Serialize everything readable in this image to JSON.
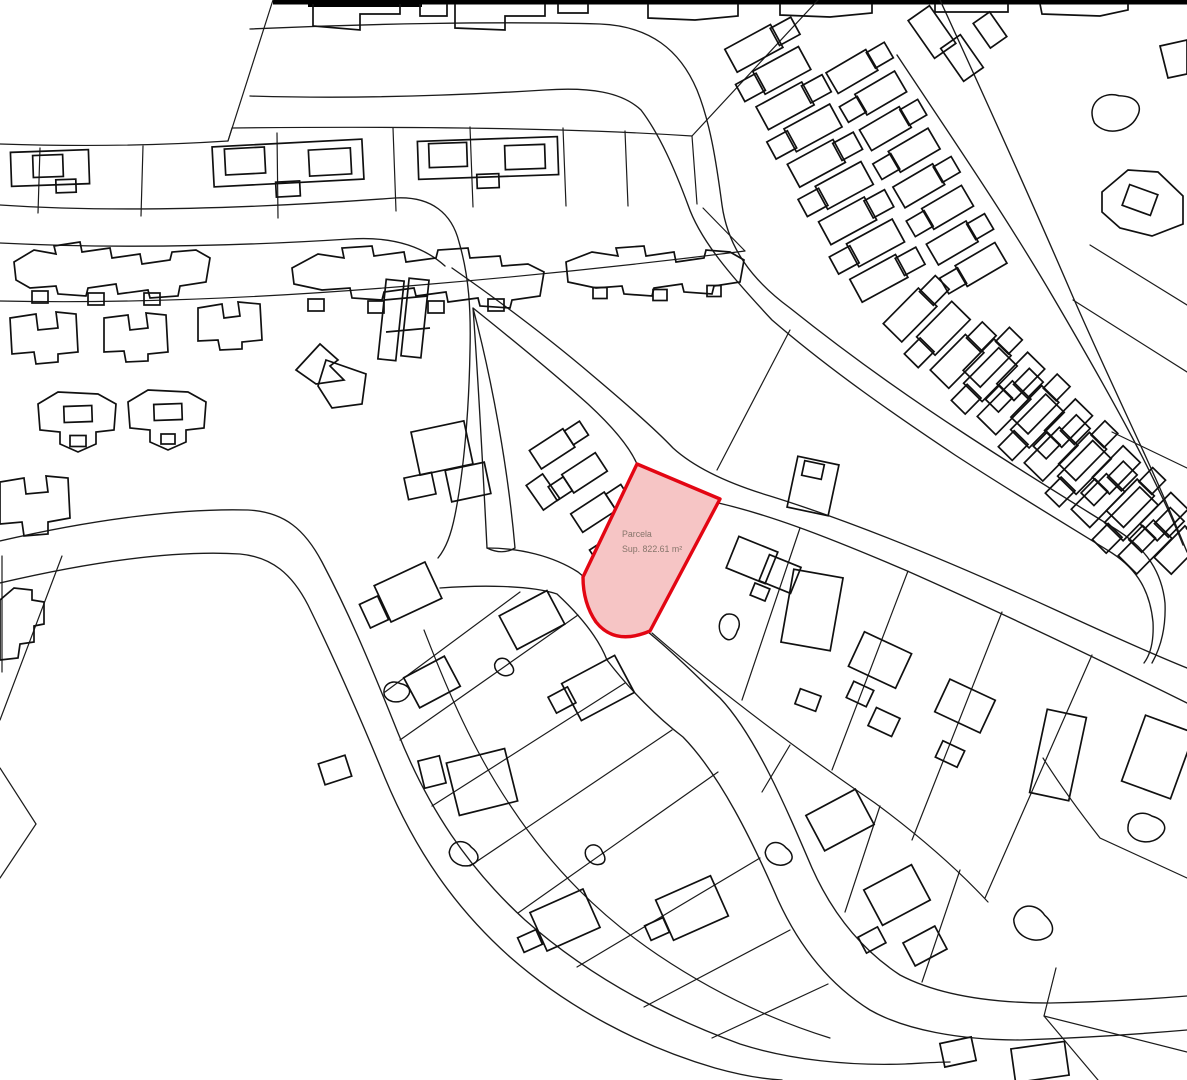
{
  "canvas": {
    "width": 1187,
    "height": 1080,
    "background": "#ffffff",
    "line_color": "#1b1b1b"
  },
  "parcel": {
    "label_line1": "Parcela",
    "label_line2": "Sup. 822.61 m²",
    "outline_color": "#e30613",
    "fill_color": "#f6c5c5",
    "label_color": "#86756b",
    "label_x": 622,
    "label_y1": 537,
    "label_y2": 552,
    "path": "M637,464 L720,499 L650,631 Q615,646 596,622 Q583,603 583,577 Z"
  },
  "map": {
    "top_bars": [
      [
        273,
        0,
        914,
        4.5
      ],
      [
        308,
        0,
        114,
        7
      ]
    ],
    "roads": [
      "M0,205 C120,213 260,208 395,198 C432,196 452,214 459,242 C469,276 471,310 470,350 C469,410 464,470 455,515 C451,535 446,548 438,558",
      "M0,243 C120,249 240,246 350,239 C395,236 425,248 445,266",
      "M473,308 C479,390 483,470 487,548 C497,553 507,553 515,548 C508,468 492,380 473,308 Z",
      "M487,548 C520,548 553,556 578,572 C600,590 625,615 648,632 C680,658 700,680 720,698 C755,735 785,805 812,868 C833,915 862,950 900,975 C938,995 992,1003 1050,1003 C1105,1002 1150,999 1187,996",
      "M440,588 C480,585 530,585 557,594 C585,620 600,642 607,660 C630,690 658,718 683,737 C720,775 752,840 778,900 C800,948 830,985 870,1010 C905,1030 960,1040 1020,1040 C1080,1038 1140,1034 1187,1030",
      "M0,541 C90,520 180,508 248,510 C285,512 305,530 322,562 C350,615 372,668 398,733 C428,808 468,868 525,920 C585,973 658,1014 740,1044 C790,1060 850,1066 905,1064 C925,1063 940,1062 950,1062",
      "M0,583 C90,562 175,550 240,554 C272,557 292,574 308,605 C335,660 358,712 385,778 C415,850 455,908 510,957 C568,1008 640,1046 715,1068 C740,1075 762,1079 782,1080",
      "M473,308 C508,336 550,370 588,404 C614,428 630,448 637,464 C645,480 670,494 699,499 C760,510 830,538 905,570 C1000,612 1100,660 1187,703",
      "M452,268 C495,298 545,335 592,375 C630,407 658,432 673,448 C695,468 730,484 770,496 C860,524 960,566 1060,612 C1110,635 1150,653 1187,668",
      "M250,96 C350,99 450,96 545,90 C590,87 622,92 641,110 C660,135 675,170 688,205 C700,240 730,275 772,320 C830,370 895,415 955,455 C1015,494 1072,528 1112,553 C1138,570 1150,592 1153,622 C1154,642 1150,655 1144,663",
      "M250,29 C360,24 500,21 600,24 C650,26 680,50 697,90 C710,122 716,160 722,205 C728,248 752,280 790,308 C845,352 905,395 965,434 C1023,472 1077,505 1117,530 C1147,549 1162,573 1165,603 C1166,627 1161,647 1152,663",
      "M897,55 C950,135 1005,215 1053,297 C1080,343 1107,390 1132,437 C1152,475 1170,512 1183,545",
      "M940,0 C985,98 1030,197 1073,297 C1097,352 1122,405 1145,455 C1162,492 1176,525 1187,552"
    ],
    "boundaries": [
      "M0,144 Q120,148 228,141",
      "M228,141 L273,0",
      "M40,148 L38,213",
      "M143,146 L141,216",
      "M277,133 L278,218",
      "M393,128 L396,211",
      "M470,127 L473,207",
      "M563,128 L566,206",
      "M625,131 L628,206",
      "M228,141 L232,128 Q420,126 560,130 Q630,132 692,136",
      "M692,136 L818,0",
      "M692,136 L697,204",
      "M0,301 C140,304 280,297 420,285 C540,275 650,263 745,251",
      "M745,251 L703,208",
      "M717,470 L790,330",
      "M1073,300 L1187,372",
      "M1112,432 L1187,468",
      "M1090,245 L1187,305",
      "M652,633 C720,692 795,748 875,803 C925,840 960,872 988,902",
      "M800,528 L742,700",
      "M908,571 L832,770",
      "M1002,612 L912,840",
      "M1092,655 L985,898",
      "M790,745 L762,792",
      "M880,806 L845,912",
      "M960,870 L922,982",
      "M424,630 C448,692 474,752 512,808 C552,868 600,916 658,955 C716,994 772,1020 830,1038",
      "M385,692 L520,592",
      "M400,740 L578,615",
      "M432,806 L625,683",
      "M470,866 L672,730",
      "M518,913 L718,772",
      "M577,967 L760,858",
      "M644,1007 L790,930",
      "M712,1038 L828,984",
      "M62,556 L0,720",
      "M0,768 L36,824",
      "M36,824 L0,878",
      "M2,556 L2,672",
      "M1043,758 C1063,790 1082,815 1100,838 L1187,878",
      "M1056,968 L1044,1016 L1098,1080",
      "M1044,1016 L1187,1052"
    ],
    "building_paths": [
      "M14,262 L34,250 L56,254 L54,246 L80,242 L82,252 L110,248 L112,258 L140,254 L142,264 L170,260 L172,252 L196,250 L210,258 L206,282 L180,286 L178,296 L150,298 L148,290 L118,294 L116,284 L88,288 L86,296 L58,294 L56,286 L30,288 L16,280 Z",
      "M292,268 L318,254 L344,258 L342,248 L372,246 L374,256 L404,252 L406,262 L436,258 L438,250 L468,248 L470,258 L500,256 L502,266 L528,264 L544,272 L540,296 L512,300 L510,308 L480,306 L478,298 L448,302 L446,292 L416,296 L414,288 L384,292 L382,300 L352,298 L350,288 L322,290 L294,284 Z",
      "M566,262 L592,252 L618,256 L616,248 L644,246 L646,256 L674,252 L676,262 L704,258 L706,250 L730,252 L744,260 L740,282 L714,286 L712,294 L684,292 L682,284 L654,288 L652,296 L624,294 L622,286 L596,288 L568,282 Z",
      "M10,318 L36,314 L38,330 L58,328 L56,312 L76,314 L78,352 L58,354 L58,362 L36,364 L34,352 L12,354 Z",
      "M104,318 L128,315 L130,330 L148,328 L146,313 L166,315 L168,352 L148,354 L148,361 L126,362 L124,351 L104,352 Z",
      "M198,308 L222,304 L224,318 L240,316 L238,302 L260,304 L262,340 L242,342 L242,349 L220,350 L218,340 L198,341 Z",
      "M38,404 L58,392 L98,394 L116,404 L114,430 L96,432 L96,444 L78,452 L60,444 L60,432 L40,430 Z",
      "M128,402 L148,390 L188,392 L206,402 L204,428 L186,430 L186,442 L168,450 L150,442 L150,430 L130,428 Z",
      "M296,370 L320,344 L338,360 L330,366 L344,380 L316,384 Z",
      "M326,360 L366,374 L362,404 L332,408 L318,386 Z",
      "M0,482 L24,478 L26,494 L48,492 L46,476 L68,478 L70,518 L48,522 L48,534 L24,536 L22,522 L0,524 Z",
      "M0,600 L14,588 L32,590 L32,600 L44,602 L44,624 L34,626 L34,642 L20,644 L18,658 L0,660 Z",
      "M1102,192 L1128,170 L1158,172 L1183,196 L1183,224 L1152,236 L1120,228 L1102,212 Z",
      "M1160,46 L1187,40 L1187,74 L1168,78 Z",
      "M384,300 L428,296",
      "M386,332 L430,328",
      "M313,4 L313,26 L360,30 L360,14 L400,14 L400,4",
      "M420,4 L420,16 L447,16 L447,4",
      "M455,4 L455,28 L505,30 L505,16 L545,16 L545,4",
      "M558,4 L558,13 L588,13 L588,4",
      "M648,4 L648,18 L695,20 L738,16 L738,4",
      "M780,4 L780,15 L830,17 L872,13 L872,4",
      "M935,4 L935,12 L1008,12 L1008,4",
      "M1040,4 L1042,14 L1100,16 L1128,10 L1128,4"
    ],
    "building_rects": [
      [
        50,
        168,
        78,
        34,
        -2
      ],
      [
        48,
        166,
        30,
        22,
        -2
      ],
      [
        66,
        186,
        20,
        13,
        -2
      ],
      [
        288,
        163,
        150,
        40,
        -3
      ],
      [
        245,
        161,
        40,
        26,
        -3
      ],
      [
        330,
        162,
        42,
        26,
        -3
      ],
      [
        288,
        189,
        24,
        15,
        -3
      ],
      [
        488,
        158,
        140,
        38,
        -2
      ],
      [
        448,
        155,
        38,
        24,
        -2
      ],
      [
        525,
        157,
        40,
        24,
        -2
      ],
      [
        488,
        181,
        22,
        14,
        -2
      ],
      [
        40,
        297,
        16,
        12,
        0
      ],
      [
        96,
        299,
        16,
        12,
        0
      ],
      [
        152,
        299,
        16,
        12,
        0
      ],
      [
        316,
        305,
        16,
        12,
        0
      ],
      [
        376,
        307,
        16,
        12,
        0
      ],
      [
        436,
        307,
        16,
        12,
        0
      ],
      [
        496,
        305,
        16,
        12,
        0
      ],
      [
        600,
        293,
        14,
        11,
        0
      ],
      [
        660,
        295,
        14,
        11,
        0
      ],
      [
        714,
        291,
        14,
        11,
        0
      ],
      [
        78,
        414,
        28,
        16,
        -2
      ],
      [
        78,
        441,
        16,
        11,
        0
      ],
      [
        168,
        412,
        28,
        16,
        -2
      ],
      [
        168,
        439,
        14,
        10,
        0
      ],
      [
        391,
        320,
        18,
        80,
        6
      ],
      [
        415,
        318,
        20,
        78,
        6
      ],
      [
        442,
        448,
        54,
        44,
        -12
      ],
      [
        468,
        482,
        40,
        32,
        -12
      ],
      [
        420,
        486,
        28,
        22,
        -12
      ],
      [
        1140,
        200,
        30,
        22,
        20
      ],
      [
        813,
        486,
        42,
        52,
        12
      ],
      [
        813,
        470,
        20,
        15,
        12
      ],
      [
        752,
        560,
        42,
        34,
        22
      ],
      [
        780,
        574,
        34,
        28,
        22
      ],
      [
        760,
        592,
        16,
        13,
        22
      ],
      [
        812,
        610,
        50,
        74,
        10
      ],
      [
        880,
        660,
        52,
        38,
        25
      ],
      [
        860,
        694,
        22,
        18,
        25
      ],
      [
        884,
        722,
        26,
        20,
        25
      ],
      [
        965,
        706,
        50,
        36,
        25
      ],
      [
        950,
        754,
        24,
        18,
        25
      ],
      [
        1058,
        755,
        40,
        85,
        12
      ],
      [
        1158,
        757,
        52,
        70,
        20
      ],
      [
        808,
        700,
        22,
        16,
        20
      ],
      [
        408,
        592,
        56,
        40,
        -25
      ],
      [
        374,
        612,
        20,
        26,
        -25
      ],
      [
        532,
        620,
        54,
        38,
        -28
      ],
      [
        432,
        682,
        46,
        34,
        -28
      ],
      [
        598,
        688,
        60,
        42,
        -28
      ],
      [
        562,
        700,
        22,
        18,
        -28
      ],
      [
        335,
        770,
        28,
        22,
        -18
      ],
      [
        482,
        782,
        60,
        54,
        -14
      ],
      [
        432,
        772,
        22,
        28,
        -14
      ],
      [
        565,
        920,
        58,
        42,
        -24
      ],
      [
        530,
        941,
        20,
        16,
        -24
      ],
      [
        692,
        908,
        60,
        44,
        -24
      ],
      [
        657,
        929,
        20,
        16,
        -24
      ],
      [
        840,
        820,
        56,
        40,
        -28
      ],
      [
        897,
        895,
        54,
        40,
        -28
      ],
      [
        872,
        940,
        22,
        18,
        -28
      ],
      [
        925,
        946,
        36,
        26,
        -28
      ],
      [
        1040,
        1062,
        54,
        34,
        -8
      ],
      [
        958,
        1052,
        32,
        24,
        -12
      ],
      [
        932,
        32,
        46,
        26,
        55
      ],
      [
        962,
        58,
        40,
        24,
        55
      ],
      [
        990,
        30,
        30,
        20,
        55
      ],
      [
        543,
        492,
        20,
        30,
        -35
      ]
    ],
    "row_chains": [
      [
        760,
        45,
        885,
        275,
        9,
        26,
        52
      ],
      [
        858,
        68,
        975,
        268,
        8,
        24,
        46
      ],
      [
        915,
        310,
        1150,
        542,
        11,
        26,
        50
      ],
      [
        992,
        358,
        1183,
        545,
        9,
        24,
        44
      ],
      [
        558,
        445,
        620,
        540,
        4,
        22,
        40
      ]
    ],
    "pools": [
      [
        465,
        855,
        16,
        10
      ],
      [
        398,
        692,
        14,
        -15
      ],
      [
        505,
        668,
        11,
        20
      ],
      [
        729,
        628,
        14,
        80
      ],
      [
        780,
        855,
        15,
        10
      ],
      [
        1035,
        925,
        22,
        15
      ],
      [
        1148,
        828,
        20,
        -10
      ],
      [
        1118,
        112,
        26,
        -25
      ],
      [
        596,
        856,
        12,
        30
      ]
    ]
  }
}
